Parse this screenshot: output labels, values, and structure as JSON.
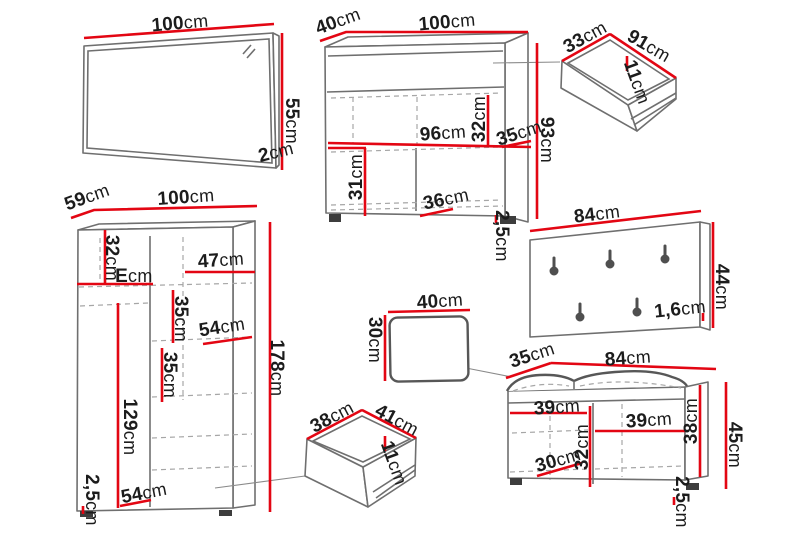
{
  "diagram": {
    "title": "hallway-furniture-dimension-diagram",
    "colors": {
      "accent_red": "#e30613",
      "outline_gray": "#6f6f6f",
      "hidden_line_gray": "#a6a6a6",
      "text": "#1c1c1c",
      "background": "#ffffff"
    },
    "items": {
      "mirror": {
        "width": {
          "v": "100",
          "u": "cm"
        },
        "height": {
          "v": "55",
          "u": "cm"
        },
        "depth": {
          "v": "2",
          "u": "cm"
        }
      },
      "sideboard": {
        "depth": {
          "v": "40",
          "u": "cm"
        },
        "width": {
          "v": "100",
          "u": "cm"
        },
        "drawer_inner_height": {
          "v": "32",
          "u": "cm"
        },
        "inner_width": {
          "v": "96",
          "u": "cm"
        },
        "side_inner_depth": {
          "v": "35",
          "u": "cm"
        },
        "lower_inner_height": {
          "v": "31",
          "u": "cm"
        },
        "door_inner_width": {
          "v": "36",
          "u": "cm"
        },
        "height": {
          "v": "93",
          "u": "cm"
        },
        "plinth": {
          "v": "2,5",
          "u": "cm"
        }
      },
      "drawer_large": {
        "depth": {
          "v": "33",
          "u": "cm"
        },
        "width": {
          "v": "91",
          "u": "cm"
        },
        "height": {
          "v": "11",
          "u": "cm"
        }
      },
      "coat_rack": {
        "width": {
          "v": "84",
          "u": "cm"
        },
        "height": {
          "v": "44",
          "u": "cm"
        },
        "thickness": {
          "v": "1,6",
          "u": "cm"
        }
      },
      "wardrobe": {
        "depth": {
          "v": "59",
          "u": "cm"
        },
        "width": {
          "v": "100",
          "u": "cm"
        },
        "top_section_height": {
          "v": "32",
          "u": "cm"
        },
        "left_shelf_width": {
          "v": "E",
          "u": "cm"
        },
        "right_shelf_width": {
          "v": "47",
          "u": "cm"
        },
        "shelf_gap_upper": {
          "v": "35",
          "u": "cm"
        },
        "shelf_depth": {
          "v": "54",
          "u": "cm"
        },
        "shelf_gap_lower": {
          "v": "35",
          "u": "cm"
        },
        "hanging_space_height": {
          "v": "129",
          "u": "cm"
        },
        "height": {
          "v": "178",
          "u": "cm"
        },
        "plinth": {
          "v": "2,5",
          "u": "cm"
        },
        "bottom_inner_width": {
          "v": "54",
          "u": "cm"
        }
      },
      "seat_cushion": {
        "width": {
          "v": "40",
          "u": "cm"
        },
        "depth": {
          "v": "30",
          "u": "cm"
        }
      },
      "drawer_small": {
        "depth": {
          "v": "38",
          "u": "cm"
        },
        "width": {
          "v": "41",
          "u": "cm"
        },
        "height": {
          "v": "11",
          "u": "cm"
        }
      },
      "shoe_bench": {
        "depth": {
          "v": "35",
          "u": "cm"
        },
        "width": {
          "v": "84",
          "u": "cm"
        },
        "left_inner_width": {
          "v": "39",
          "u": "cm"
        },
        "right_inner_width": {
          "v": "39",
          "u": "cm"
        },
        "inner_height": {
          "v": "32",
          "u": "cm"
        },
        "side_inner_height": {
          "v": "38",
          "u": "cm"
        },
        "bottom_inner_width": {
          "v": "30",
          "u": "cm"
        },
        "height": {
          "v": "45",
          "u": "cm"
        },
        "plinth": {
          "v": "2,5",
          "u": "cm"
        }
      }
    }
  }
}
